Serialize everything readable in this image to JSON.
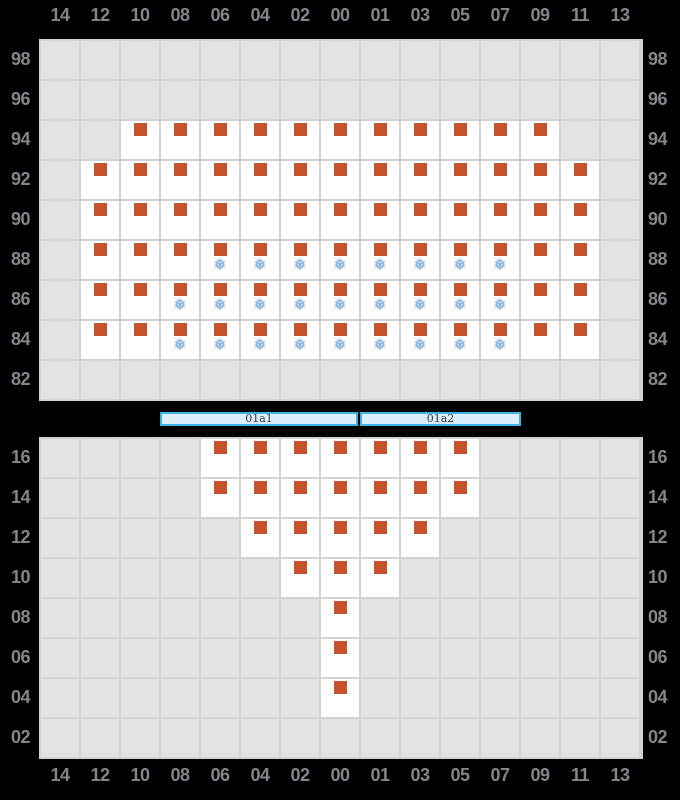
{
  "colors": {
    "background": "#000000",
    "grid-line": "#d2d2d7",
    "cell-empty": "#e3e3e6",
    "cell-filled": "#ffffff",
    "axis-label": "#85858d",
    "square": "#c5522a",
    "snowflake": "#72a9db",
    "bar-border": "#3fb2e6",
    "bar-fill": "#dbeefa",
    "bar-text": "#3a3a3a"
  },
  "icons": {
    "snowflake": "❅"
  },
  "range_bar": {
    "segments": [
      {
        "label": "01a1"
      },
      {
        "label": "01a2"
      }
    ]
  },
  "chart_data": {
    "type": "heatmap",
    "title": "",
    "xlabel": "",
    "ylabel": "",
    "grid": true,
    "x_labels": [
      "14",
      "12",
      "10",
      "08",
      "06",
      "04",
      "02",
      "00",
      "01",
      "03",
      "05",
      "07",
      "09",
      "11",
      "13"
    ],
    "cell_codes": {
      "0": "empty gray cell (no data)",
      "1": "white cell with orange square marker",
      "2": "white cell with orange square marker and blue snowflake icon"
    },
    "panels": [
      {
        "id": "top-panel",
        "name": "upper-grid",
        "y_labels": [
          "98",
          "96",
          "94",
          "92",
          "90",
          "88",
          "86",
          "84",
          "82"
        ],
        "rows": [
          "000000000000000",
          "000000000000000",
          "001111111111100",
          "011111111111110",
          "011111111111110",
          "011122222222110",
          "011222222222110",
          "011222222222110",
          "000000000000000"
        ]
      },
      {
        "id": "bottom-panel",
        "name": "lower-grid",
        "y_labels": [
          "16",
          "14",
          "12",
          "10",
          "08",
          "06",
          "04",
          "02"
        ],
        "rows": [
          "000011111110000",
          "000011111110000",
          "000001111100000",
          "000000111000000",
          "000000010000000",
          "000000010000000",
          "000000010000000",
          "000000000000000"
        ]
      }
    ]
  }
}
